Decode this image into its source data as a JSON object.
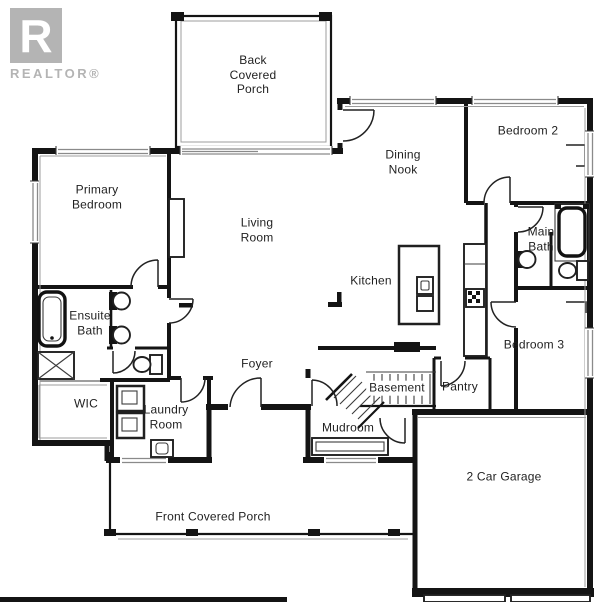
{
  "branding": {
    "logo_letter": "R",
    "logo_text": "REALTOR®"
  },
  "rooms": [
    {
      "id": "back-covered-porch",
      "label": "Back\nCovered\nPorch"
    },
    {
      "id": "dining-nook",
      "label": "Dining\nNook"
    },
    {
      "id": "bedroom-2",
      "label": "Bedroom 2"
    },
    {
      "id": "primary-bedroom",
      "label": "Primary\nBedroom"
    },
    {
      "id": "living-room",
      "label": "Living\nRoom"
    },
    {
      "id": "main-bath",
      "label": "Main\nBath"
    },
    {
      "id": "kitchen",
      "label": "Kitchen"
    },
    {
      "id": "ensuite-bath",
      "label": "Ensuite\nBath"
    },
    {
      "id": "bedroom-3",
      "label": "Bedroom 3"
    },
    {
      "id": "foyer",
      "label": "Foyer"
    },
    {
      "id": "wic",
      "label": "WIC"
    },
    {
      "id": "basement",
      "label": "Basement"
    },
    {
      "id": "pantry",
      "label": "Pantry"
    },
    {
      "id": "laundry-room",
      "label": "Laundry\nRoom"
    },
    {
      "id": "mudroom",
      "label": "Mudroom"
    },
    {
      "id": "garage",
      "label": "2 Car Garage"
    },
    {
      "id": "front-covered-porch",
      "label": "Front Covered Porch"
    }
  ],
  "fixtures": [
    "bathtub-icon",
    "shower-icon",
    "toilet-icon",
    "sink-icon",
    "double-vanity-icon",
    "washer-icon",
    "dryer-icon",
    "laundry-tub-icon",
    "kitchen-island-icon",
    "island-sink-icon",
    "cooktop-icon",
    "counter-icon",
    "fireplace-icon",
    "stairs-icon",
    "bench-icon",
    "door-swing-icon",
    "window-icon",
    "porch-post-icon",
    "garage-door-icon"
  ],
  "palette": {
    "wall": "#141414",
    "door": "#222222",
    "window_frame": "#8a8a8a",
    "logo_gray": "#b4b4b4",
    "label_text": "#1f1f1f",
    "background": "#ffffff"
  }
}
